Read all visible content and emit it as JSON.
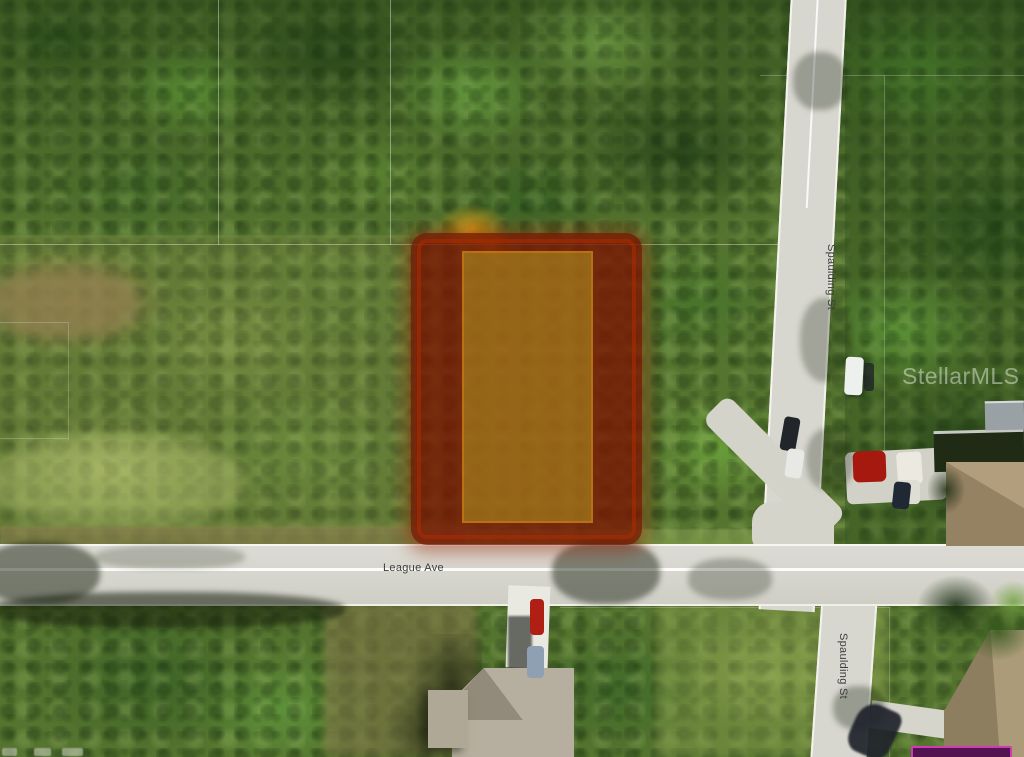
{
  "map": {
    "street_labels": {
      "league_ave": "League Ave",
      "spaulding_upper": "Spaulding St",
      "spaulding_lower": "Spaulding St"
    },
    "watermark": "StellarMLS",
    "highlighted_parcel": {
      "outer_highlight_color": "#7a1602",
      "inner_highlight_color": "#c6ba2a",
      "border_glow_color": "#b22a00"
    },
    "cropped_tag": {
      "border_color": "#cf3bb5",
      "fill_color": "#531250"
    }
  }
}
